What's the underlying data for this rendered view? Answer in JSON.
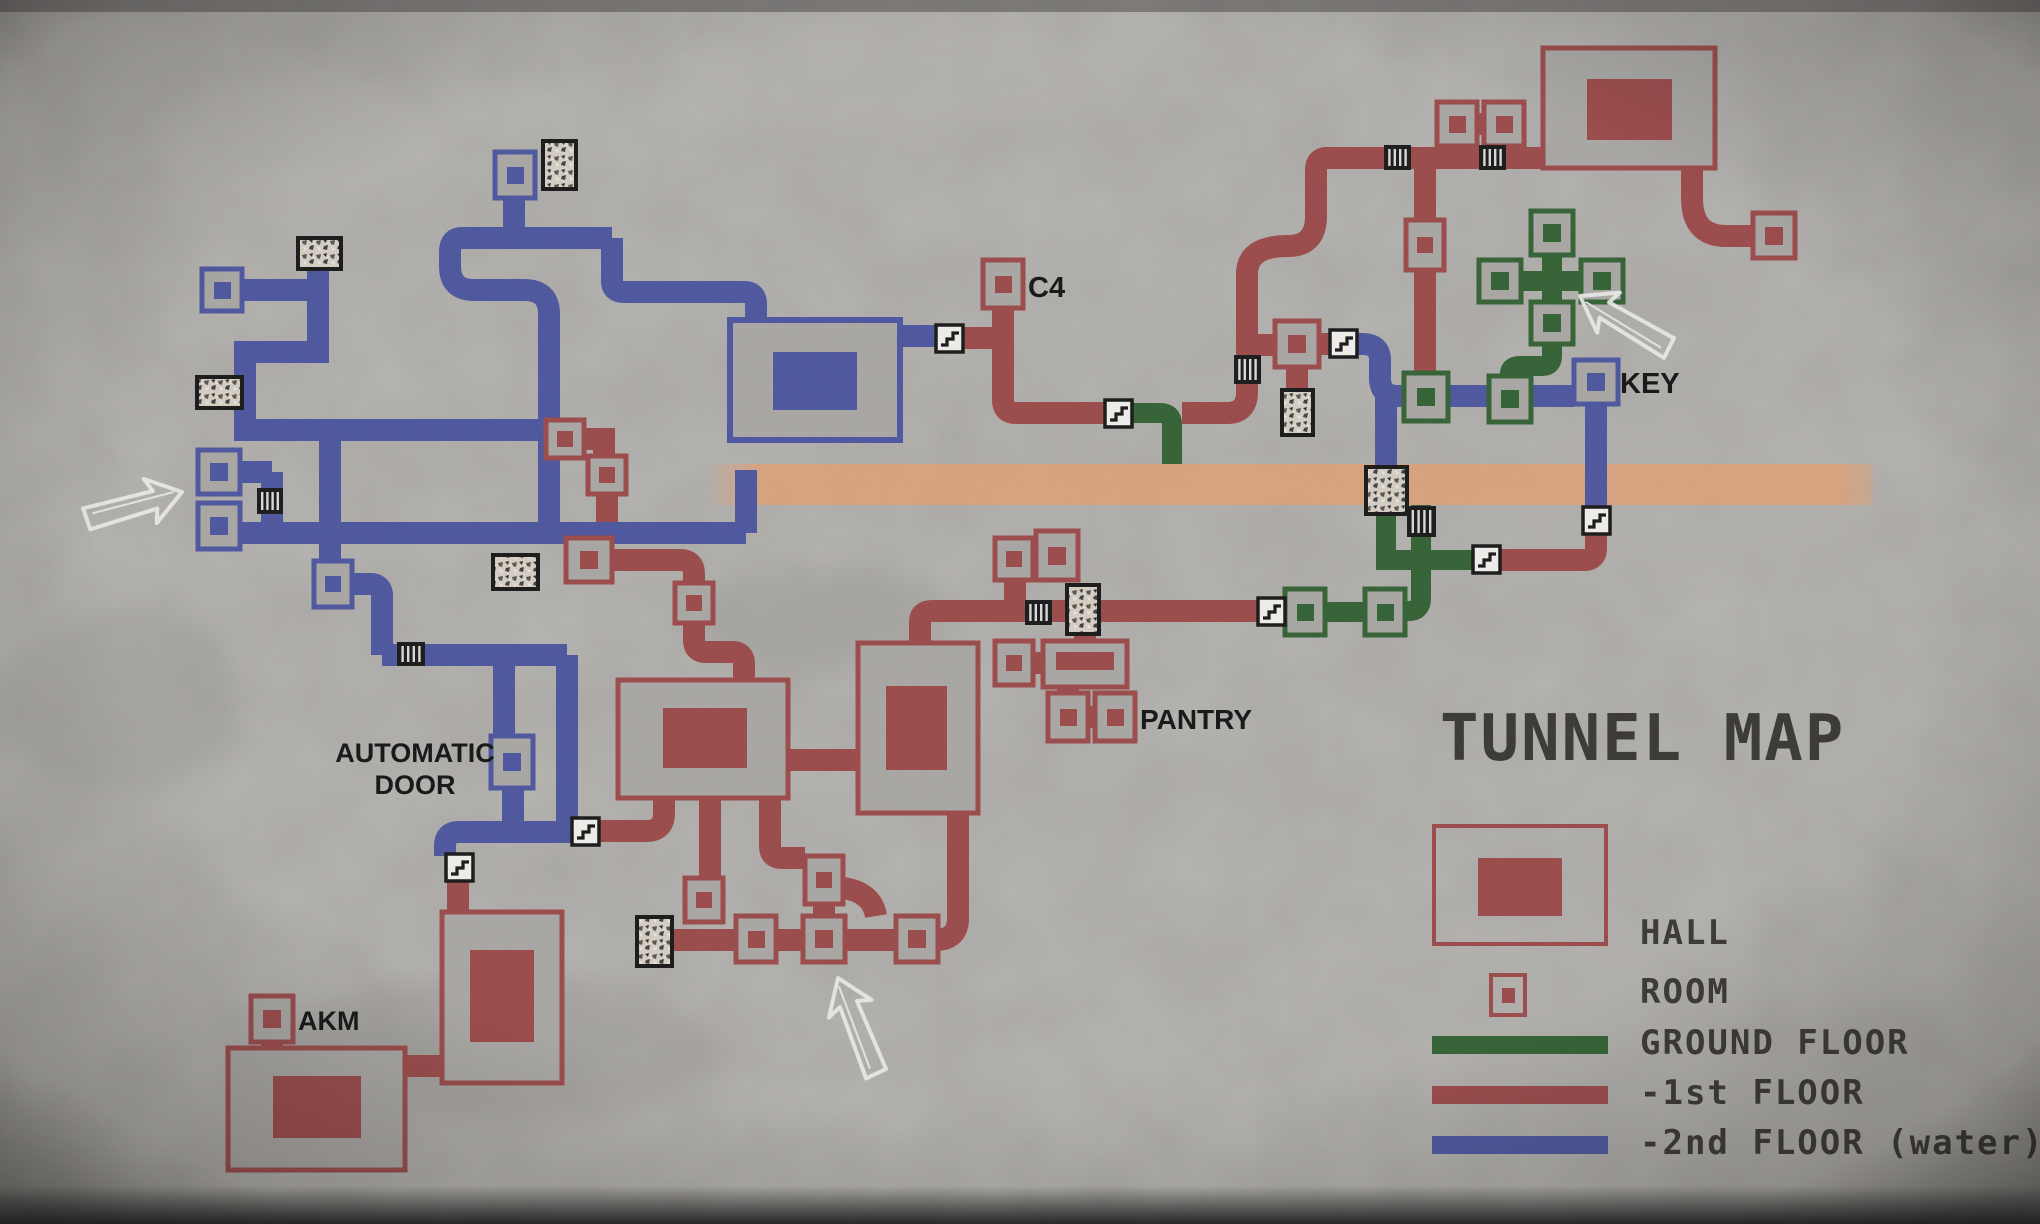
{
  "title": "TUNNEL MAP",
  "labels": {
    "c4": "C4",
    "key": "KEY",
    "pantry": "PANTRY",
    "automatic_door_1": "AUTOMATIC",
    "automatic_door_2": "DOOR",
    "akm": "AKM"
  },
  "legend": {
    "hall_label": "HALL",
    "room_label": "ROOM",
    "ground_floor_label": "GROUND FLOOR",
    "first_floor_label": "-1st FLOOR",
    "second_floor_label": "-2nd FLOOR (water)"
  },
  "colors": {
    "ground_floor": "#2d5e2e",
    "first_floor": "#9a4545",
    "second_floor": "#48529e",
    "passage_band": "#dfa077",
    "concrete": "#a9a7a4",
    "label_ink": "#0d0d0d",
    "title_ink": "#343230"
  },
  "icons": {
    "stairs": "stairs-icon",
    "vent": "vent-grate-icon",
    "rubble": "collapsed-rubble-icon",
    "arrow": "entrance-arrow-icon"
  }
}
